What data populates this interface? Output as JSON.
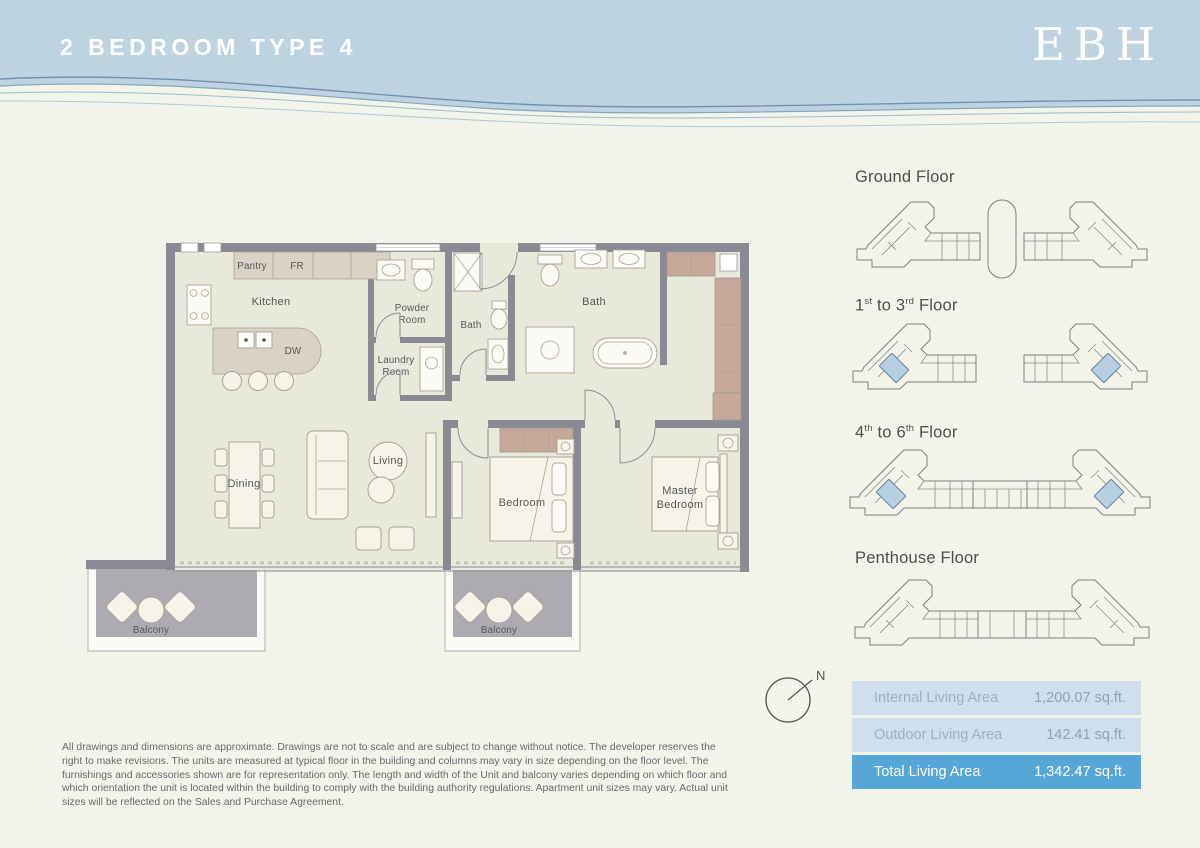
{
  "header": {
    "title": "2 BEDROOM TYPE 4",
    "logo": "EBH"
  },
  "floor_plan": {
    "rooms": {
      "pantry": "Pantry",
      "fr": "FR",
      "kitchen": "Kitchen",
      "dw": "DW",
      "powder_line1": "Powder",
      "powder_line2": "Room",
      "laundry_line1": "Laundry",
      "laundry_line2": "Room",
      "bath_guest": "Bath",
      "bath_master": "Bath",
      "dining": "Dining",
      "living": "Living",
      "bedroom": "Bedroom",
      "master_line1": "Master",
      "master_line2": "Bedroom",
      "balcony_left": "Balcony",
      "balcony_right": "Balcony"
    }
  },
  "key_plans": {
    "levels": [
      {
        "label": "Ground Floor"
      },
      {
        "num1": "1",
        "sup1": "st",
        "mid": " to ",
        "num2": "3",
        "sup2": "rd",
        "tail": " Floor"
      },
      {
        "num1": "4",
        "sup1": "th",
        "mid": " to ",
        "num2": "6",
        "sup2": "th",
        "tail": " Floor"
      },
      {
        "label": "Penthouse Floor"
      }
    ]
  },
  "compass": {
    "north": "N"
  },
  "area_table": {
    "rows": [
      {
        "label": "Internal Living Area",
        "value": "1,200.07 sq.ft."
      },
      {
        "label": "Outdoor Living Area",
        "value": "142.41 sq.ft."
      },
      {
        "label": "Total Living Area",
        "value": "1,342.47 sq.ft."
      }
    ]
  },
  "disclaimer": "All drawings and dimensions are approximate. Drawings are not to scale and are subject to change without notice. The developer reserves the right to make revisions. The units are measured at typical floor in the building and columns may vary in size depending on the floor level. The furnishings and accessories shown are for representation only. The length and width of the Unit and balcony varies depending on which floor and which orientation the unit is located within the building to comply with the building authority regulations. Apartment unit sizes may vary. Actual unit sizes will be reflected on the Sales and Purchase Agreement.",
  "colors": {
    "header_blue": "#bed3e1",
    "page_cream": "#f2f4ea",
    "wall_gray": "#8a8a94",
    "floor_sage": "#e8e9da",
    "cabinet_taupe": "#d9d2c5",
    "wardrobe_rose": "#c7a99c",
    "balcony_gray": "#aeaab2",
    "table_row_blue": "#cfdfeb",
    "table_highlight_blue": "#56a7d8",
    "keyplan_unit_blue": "#b6d0e2"
  }
}
